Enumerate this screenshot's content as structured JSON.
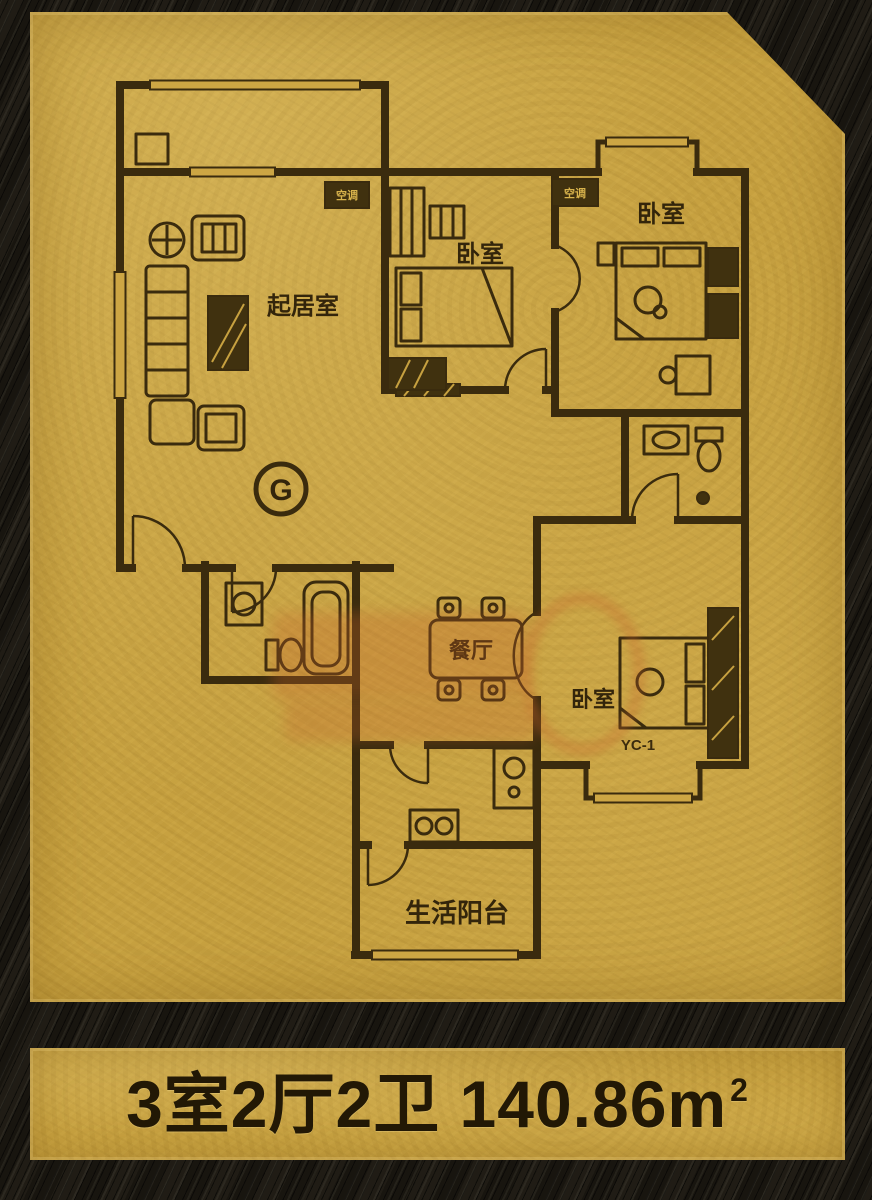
{
  "footer": {
    "layout": "3室2厅2卫",
    "area": "140.86m",
    "area_exponent": "2"
  },
  "plan": {
    "unit_label": "G",
    "window_code": "YC-1",
    "ac_labels": [
      "空调",
      "空调"
    ],
    "rooms": {
      "living": "起居室",
      "bedroom_top": "卧室",
      "bedroom_right": "卧室",
      "bedroom_bottom": "卧室",
      "dining": "餐厅",
      "balcony": "生活阳台"
    }
  },
  "colors": {
    "gold_plate": "#c7a140",
    "plan_line": "#3a2b0e",
    "background": "#18150f",
    "watermark": "#c2622a",
    "footer_text": "#221805"
  }
}
